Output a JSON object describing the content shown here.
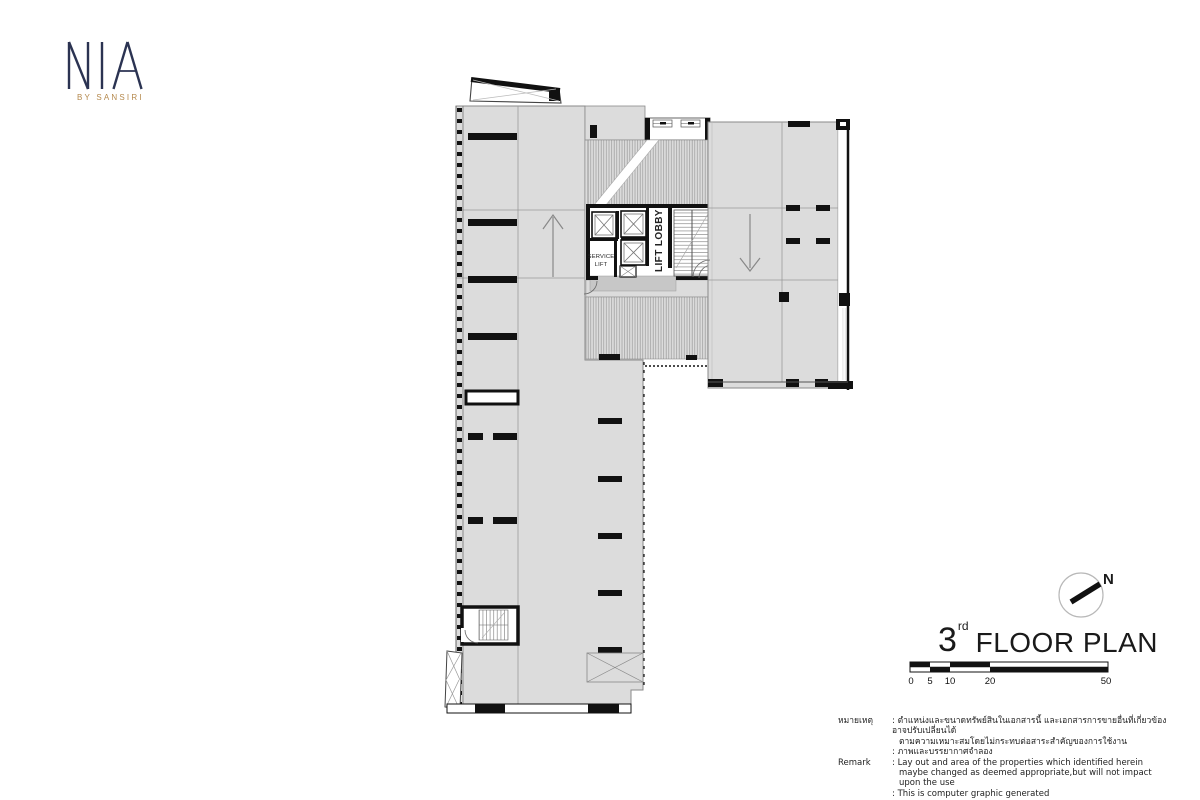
{
  "logo": {
    "brand": "NIA",
    "sub": "BY SANSIRI",
    "navy": "#2b3352",
    "gold": "#b5894d"
  },
  "plan": {
    "lift_lobby_label": "LIFT LOBBY",
    "service_lift_line1": "SERVICE",
    "service_lift_line2": "LIFT",
    "colors": {
      "floor_fill": "#dcdcdc",
      "lobby_landing_fill": "#c7c7c7",
      "wall": "#111111",
      "hatch_line": "#9a9a9a",
      "outline": "#8a8a8a"
    }
  },
  "compass": {
    "label": "N"
  },
  "title": {
    "number": "3",
    "ordinal": "rd",
    "text": "FLOOR PLAN"
  },
  "scalebar": {
    "labels": [
      "0",
      "5",
      "10",
      "20",
      "50"
    ]
  },
  "remark": {
    "label_th": "หมายเหตุ",
    "th1": ": ตำแหน่งและขนาดทรัพย์สินในเอกสารนี้ และเอกสารการขายอื่นที่เกี่ยวข้อง อาจปรับเปลี่ยนได้",
    "th2": "ตามความเหมาะสมโดยไม่กระทบต่อสาระสำคัญของการใช้งาน",
    "th3": ": ภาพและบรรยากาศจำลอง",
    "label_en": "Remark",
    "en1": ": Lay out and area of the properties which identified herein",
    "en2": "maybe changed as deemed appropriate,but will not impact upon the use",
    "en3": ": This is computer graphic generated"
  }
}
